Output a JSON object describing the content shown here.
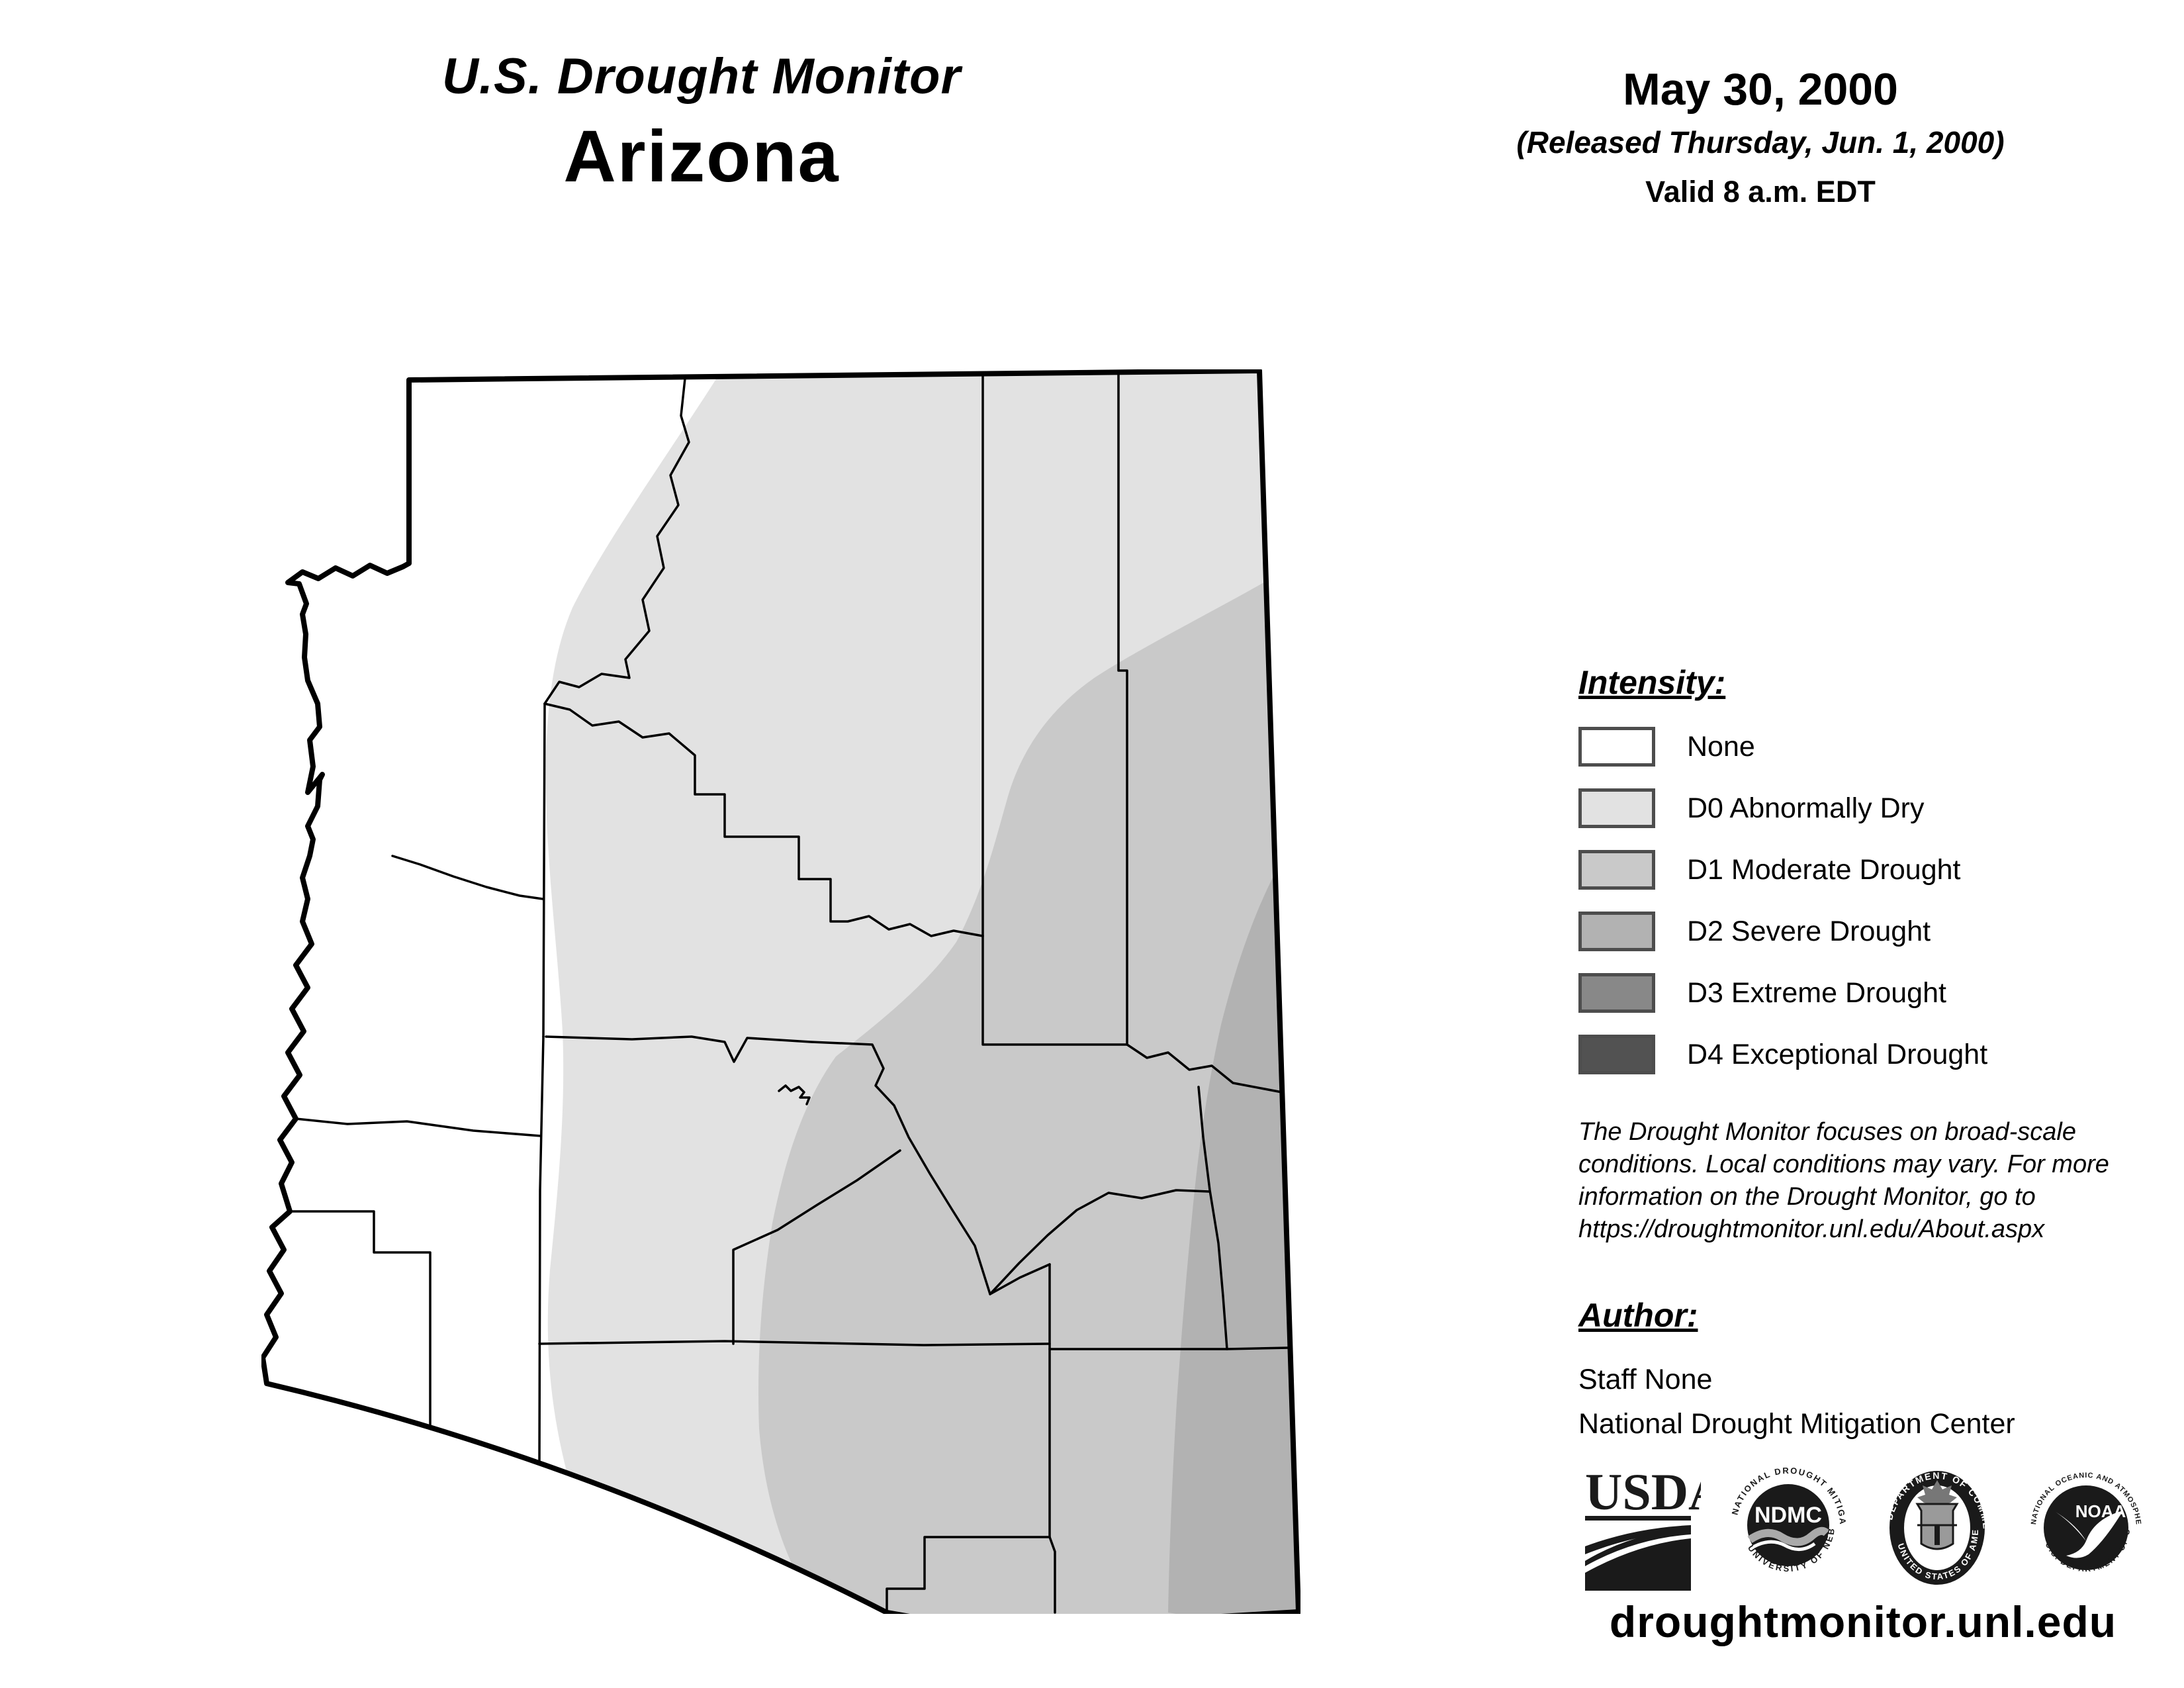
{
  "header": {
    "title": "U.S. Drought Monitor",
    "region": "Arizona",
    "date": "May 30, 2000",
    "released": "(Released Thursday, Jun. 1, 2000)",
    "valid": "Valid 8 a.m. EDT"
  },
  "legend": {
    "heading": "Intensity:",
    "items": [
      {
        "code": "",
        "label": "None",
        "color": "#ffffff"
      },
      {
        "code": "D0",
        "label": "D0 Abnormally Dry",
        "color": "#e2e2e2"
      },
      {
        "code": "D1",
        "label": "D1 Moderate Drought",
        "color": "#c9c9c9"
      },
      {
        "code": "D2",
        "label": "D2 Severe Drought",
        "color": "#b2b2b2"
      },
      {
        "code": "D3",
        "label": "D3 Extreme Drought",
        "color": "#888888"
      },
      {
        "code": "D4",
        "label": "D4 Exceptional Drought",
        "color": "#525252"
      }
    ],
    "border_color": "#4d4d4d"
  },
  "disclaimer": {
    "line1": "The Drought Monitor focuses on broad-scale",
    "line2": "conditions. Local conditions may vary. For more",
    "line3": "information on the Drought Monitor, go to",
    "line4": "https://droughtmonitor.unl.edu/About.aspx"
  },
  "author": {
    "heading": "Author:",
    "name": "Staff None",
    "org": "National Drought Mitigation Center"
  },
  "logos": {
    "usda": "USDA",
    "ndmc": "NDMC",
    "ndmc_ring_top": "NATIONAL DROUGHT MITIGATION CENTER",
    "ndmc_ring_bottom": "UNIVERSITY OF NEBRASKA",
    "doc_ring_top": "DEPARTMENT OF COMMERCE",
    "doc_ring_bottom": "UNITED STATES OF AMERICA",
    "noaa": "NOAA",
    "noaa_ring_top": "NATIONAL OCEANIC AND ATMOSPHERIC ADMINISTRATION",
    "noaa_ring_bottom": "U.S. DEPARTMENT OF COMMERCE"
  },
  "footer": {
    "url": "droughtmonitor.unl.edu"
  },
  "map": {
    "state": "Arizona",
    "regions_shown": [
      "None",
      "D0",
      "D1",
      "D2"
    ],
    "line_color": "#000000"
  }
}
